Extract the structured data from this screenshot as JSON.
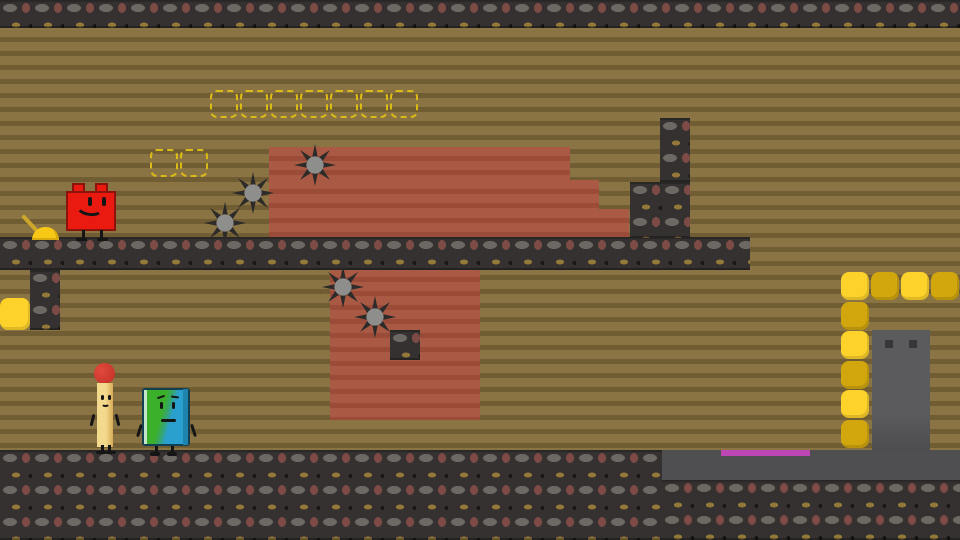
{
  "scene": {
    "type": "2d-platformer-level",
    "palette": {
      "background_stripe_light": "#8b7443",
      "background_stripe_dark": "#705d33",
      "terrain_dark": "#343130",
      "rust_light": "#aa5a44",
      "rust_dark": "#9a4c39",
      "coin_bright": "#fdd22b",
      "coin_dark": "#d2a70e",
      "coin_outline_dashed": "#d9ba17",
      "finish_bar": "#bd46b5",
      "door_gray": "#565658",
      "stone_platform_gray": "#4f4e50",
      "spike_dark": "#2d2b29",
      "spike_hub": "#8e8e8c",
      "lever_yellow": "#f7c815"
    },
    "counts": {
      "spike_hazards": 5,
      "coins_remaining": 10,
      "coin_outlines_collected": 9,
      "characters": 3
    },
    "characters": [
      {
        "name": "blocky",
        "description": "red lego brick character with smiling face",
        "color": "#ea1a10",
        "x": 64,
        "y": 182
      },
      {
        "name": "match",
        "description": "matchstick character with red round tip",
        "color": "#e8c87e",
        "x": 93,
        "y": 362
      },
      {
        "name": "book",
        "description": "green and teal book character with neutral face",
        "color": "#3bb02a",
        "x": 141,
        "y": 386
      }
    ],
    "entities": [
      {
        "t": "rust",
        "x": 269,
        "y": 147,
        "w": 301,
        "h": 33
      },
      {
        "t": "rust",
        "x": 269,
        "y": 180,
        "w": 330,
        "h": 29
      },
      {
        "t": "rust",
        "x": 269,
        "y": 209,
        "w": 360,
        "h": 30
      },
      {
        "t": "rust",
        "x": 330,
        "y": 268,
        "w": 150,
        "h": 152
      },
      {
        "t": "ground",
        "x": 0,
        "y": 0,
        "w": 960,
        "h": 28
      },
      {
        "t": "ground",
        "x": 0,
        "y": 237,
        "w": 750,
        "h": 33
      },
      {
        "t": "ground",
        "x": 30,
        "y": 270,
        "w": 30,
        "h": 60
      },
      {
        "t": "ground",
        "x": 660,
        "y": 118,
        "w": 30,
        "h": 64
      },
      {
        "t": "ground",
        "x": 630,
        "y": 182,
        "w": 60,
        "h": 56
      },
      {
        "t": "ground",
        "x": 390,
        "y": 330,
        "w": 30,
        "h": 30
      },
      {
        "t": "ground",
        "x": 0,
        "y": 450,
        "w": 662,
        "h": 90
      },
      {
        "t": "ground",
        "x": 662,
        "y": 480,
        "w": 298,
        "h": 60
      },
      {
        "t": "gray",
        "x": 662,
        "y": 450,
        "w": 298,
        "h": 30
      },
      {
        "t": "door",
        "x": 872,
        "y": 330,
        "w": 58,
        "h": 120
      },
      {
        "t": "finish",
        "x": 721,
        "y": 450,
        "w": 89,
        "h": 6
      },
      {
        "t": "box",
        "x": 210,
        "y": 90,
        "w": 28,
        "h": 28
      },
      {
        "t": "box",
        "x": 240,
        "y": 90,
        "w": 28,
        "h": 28
      },
      {
        "t": "box",
        "x": 270,
        "y": 90,
        "w": 28,
        "h": 28
      },
      {
        "t": "box",
        "x": 300,
        "y": 90,
        "w": 28,
        "h": 28
      },
      {
        "t": "box",
        "x": 330,
        "y": 90,
        "w": 28,
        "h": 28
      },
      {
        "t": "box",
        "x": 360,
        "y": 90,
        "w": 28,
        "h": 28
      },
      {
        "t": "box",
        "x": 390,
        "y": 90,
        "w": 28,
        "h": 28
      },
      {
        "t": "box",
        "x": 150,
        "y": 149,
        "w": 28,
        "h": 28
      },
      {
        "t": "box",
        "x": 180,
        "y": 149,
        "w": 28,
        "h": 28
      },
      {
        "t": "coin",
        "v": "bright",
        "x": 0,
        "y": 298,
        "w": 30,
        "h": 32
      },
      {
        "t": "coin",
        "v": "bright",
        "x": 841,
        "y": 272,
        "w": 28,
        "h": 28
      },
      {
        "t": "coin",
        "v": "dark",
        "x": 871,
        "y": 272,
        "w": 28,
        "h": 28
      },
      {
        "t": "coin",
        "v": "bright",
        "x": 901,
        "y": 272,
        "w": 28,
        "h": 28
      },
      {
        "t": "coin",
        "v": "dark",
        "x": 931,
        "y": 272,
        "w": 28,
        "h": 28
      },
      {
        "t": "coin",
        "v": "dark",
        "x": 841,
        "y": 302,
        "w": 28,
        "h": 28
      },
      {
        "t": "coin",
        "v": "bright",
        "x": 841,
        "y": 331,
        "w": 28,
        "h": 28
      },
      {
        "t": "coin",
        "v": "dark",
        "x": 841,
        "y": 361,
        "w": 28,
        "h": 28
      },
      {
        "t": "coin",
        "v": "bright",
        "x": 841,
        "y": 390,
        "w": 28,
        "h": 28
      },
      {
        "t": "coin",
        "v": "dark",
        "x": 841,
        "y": 420,
        "w": 28,
        "h": 28
      },
      {
        "t": "spike",
        "x": 292,
        "y": 142,
        "w": 46,
        "h": 46
      },
      {
        "t": "spike",
        "x": 230,
        "y": 170,
        "w": 46,
        "h": 46
      },
      {
        "t": "spike",
        "x": 202,
        "y": 200,
        "w": 46,
        "h": 46
      },
      {
        "t": "spike",
        "x": 320,
        "y": 264,
        "w": 46,
        "h": 46
      },
      {
        "t": "spike",
        "x": 352,
        "y": 294,
        "w": 46,
        "h": 46
      },
      {
        "t": "lever",
        "x": 22,
        "y": 212,
        "w": 40,
        "h": 28
      }
    ]
  }
}
